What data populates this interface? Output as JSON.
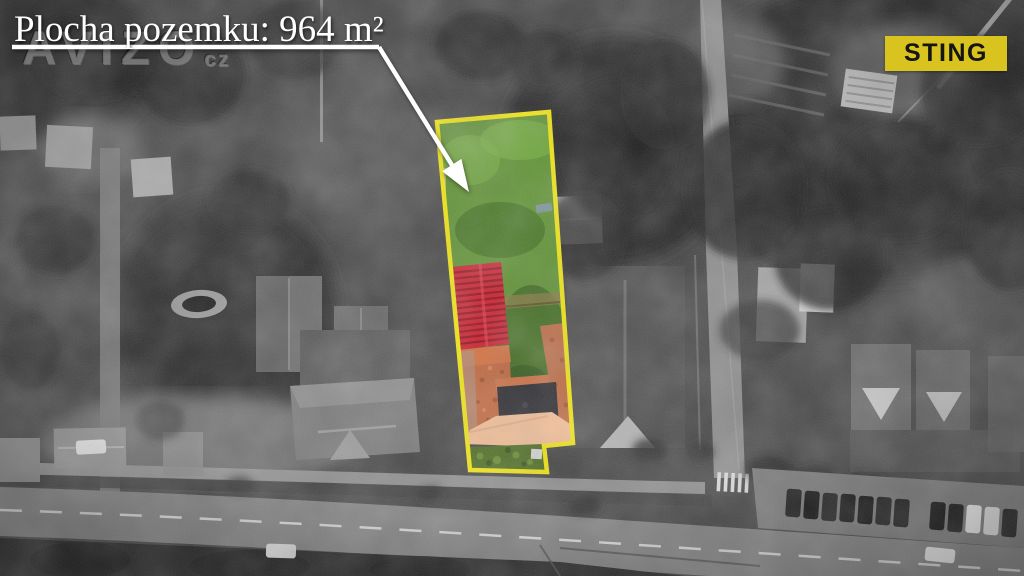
{
  "annotation": {
    "area_label": "Plocha pozemku: 964 m²"
  },
  "watermark": {
    "name": "AVIZO",
    "tld": "cz"
  },
  "brand": {
    "label": "STING",
    "bg": "#d9c31e",
    "fg": "#151515"
  },
  "colors": {
    "parcel_outline": "#f2e60e",
    "lawn": "#5d9130",
    "lawn_dark": "#3c681c",
    "red_roof": "#c92130",
    "red_roof_stripe": "#97131f",
    "orange_roof": "#c0663c",
    "orange_band": "#cd6f41",
    "dark_roof": "#26262b",
    "peach_roof": "#f3bd94",
    "garden_strip": "#4a6a1d"
  }
}
